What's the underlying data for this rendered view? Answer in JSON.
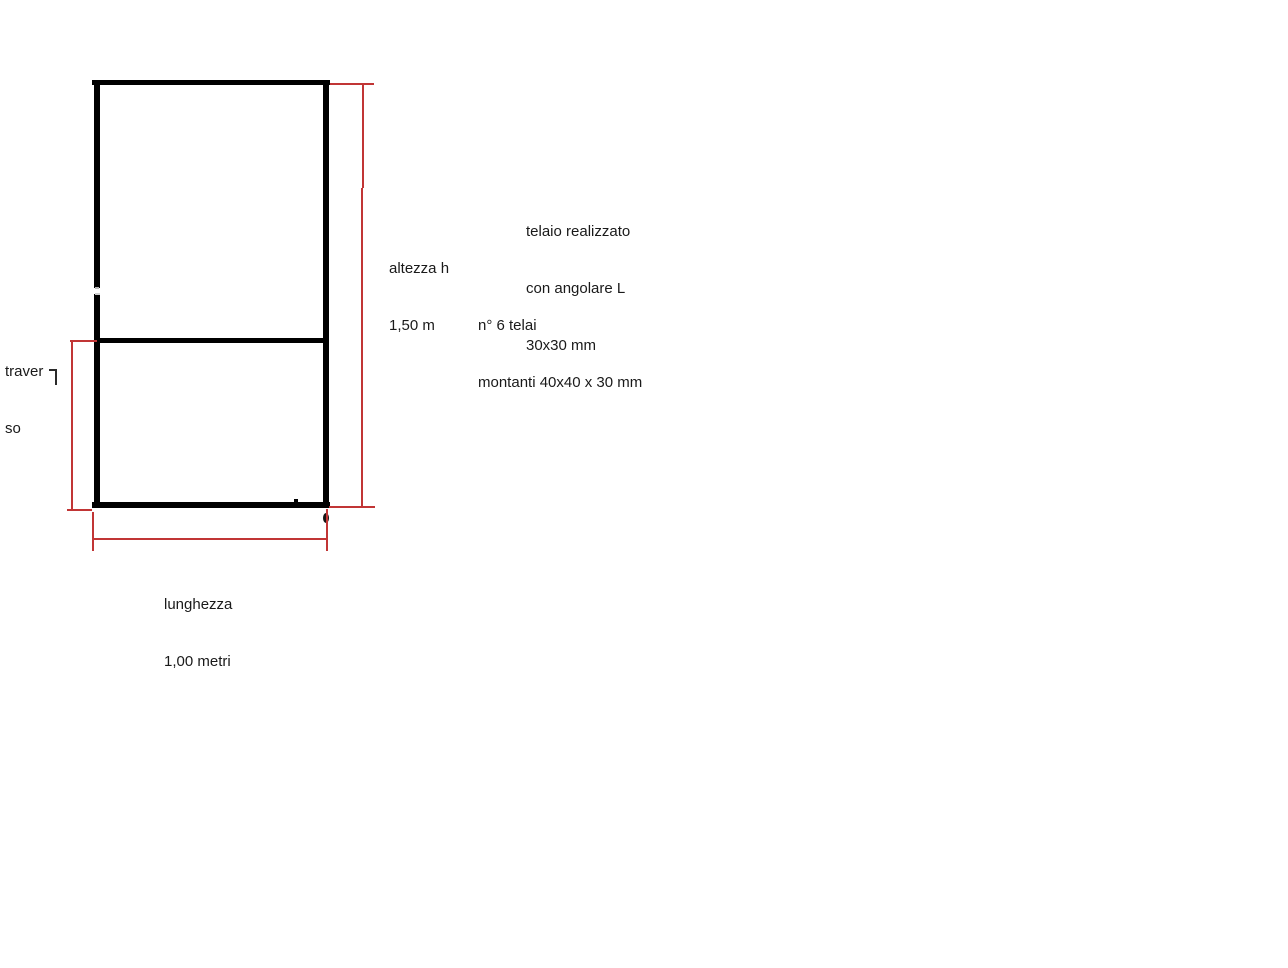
{
  "canvas": {
    "background": "#ffffff",
    "width": 1288,
    "height": 968
  },
  "drawing": {
    "frame_stroke_color": "#000000",
    "dimension_line_color": "#c13535",
    "labels": {
      "altezza": {
        "lines": [
          "altezza h",
          "1,50 m"
        ]
      },
      "lunghezza": {
        "lines": [
          "lunghezza",
          "1,00 metri"
        ]
      },
      "traverso": {
        "word": "traverso",
        "lines": [
          "traver",
          "so"
        ]
      }
    },
    "notes": {
      "telaio": {
        "lines": [
          "telaio realizzato",
          "con angolare L",
          "30x30 mm"
        ]
      },
      "montanti": {
        "lines": [
          "n° 6 telai",
          "montanti 40x40 x 30 mm"
        ]
      }
    },
    "marks": {
      "stray_stroke": "small hooked vertical stroke fragment",
      "weld_dot": "black oval dot below bottom-right corner"
    }
  }
}
